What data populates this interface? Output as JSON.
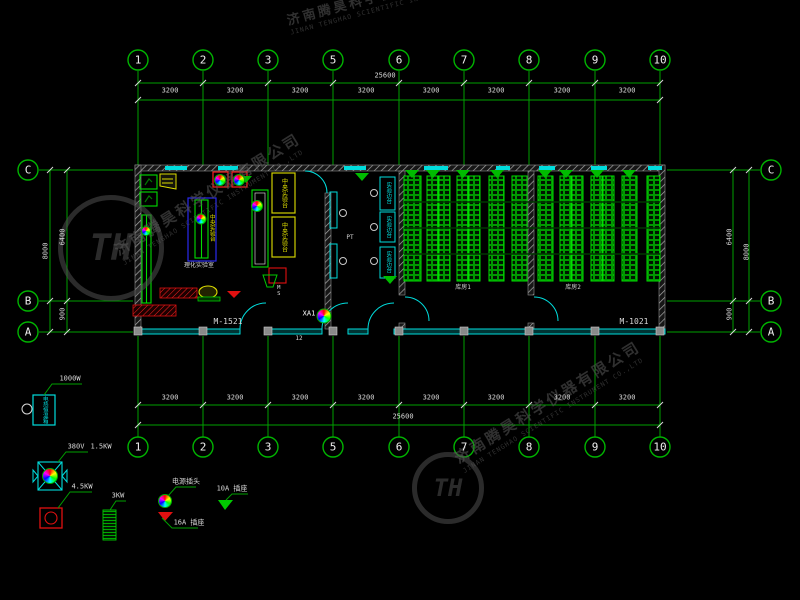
{
  "grid": {
    "cols": [
      "1",
      "2",
      "3",
      "5",
      "6",
      "7",
      "8",
      "9",
      "10"
    ],
    "rows": [
      "C",
      "B",
      "A"
    ],
    "bay": "3200",
    "top_total": "25600",
    "bottom_total": "25600",
    "left": {
      "total": "8000",
      "upper": "6400",
      "lower": "900"
    },
    "right": {
      "total": "8000",
      "upper": "6400",
      "lower": "900"
    }
  },
  "plan": {
    "rooms": {
      "lab_label": "理化实验室",
      "storage1_label": "库房1",
      "storage2_label": "库房2",
      "pt_label": "PT",
      "ms_label": "MS",
      "note": "12"
    },
    "benches": {
      "central_bench": "中央实验台",
      "side_bench": "实验边台"
    },
    "doors": {
      "left": "M-1521",
      "right": "M-1021"
    },
    "panel": "XA1"
  },
  "legend": {
    "items": [
      {
        "name": "oven",
        "label": "1000W",
        "text": "电热恒温箱"
      },
      {
        "name": "transformer",
        "volt": "380V",
        "power": "1.5KW"
      },
      {
        "name": "red-unit",
        "power": "4.5KW"
      },
      {
        "name": "radiator",
        "power": "3KW"
      },
      {
        "name": "power-plug",
        "label": "电源插头"
      },
      {
        "name": "socket-16a",
        "label": "16A 插座"
      },
      {
        "name": "socket-10a",
        "label": "10A 插座"
      }
    ]
  },
  "watermark": {
    "cn": "济南腾昊科学仪器有限公司",
    "en": "JINAN TENGHAO SCIENTIFIC INSTRUMENT CO.,LTD",
    "logo": "TH"
  },
  "colors": {
    "grid_green": "#00a000",
    "bright_green": "#00e000",
    "wall_cyan": "#00dcdc",
    "bench_yellow": "#d8d800",
    "alert_red": "#ff2020",
    "blue": "#2a2aee",
    "dim_text": "#d8d8d8"
  }
}
